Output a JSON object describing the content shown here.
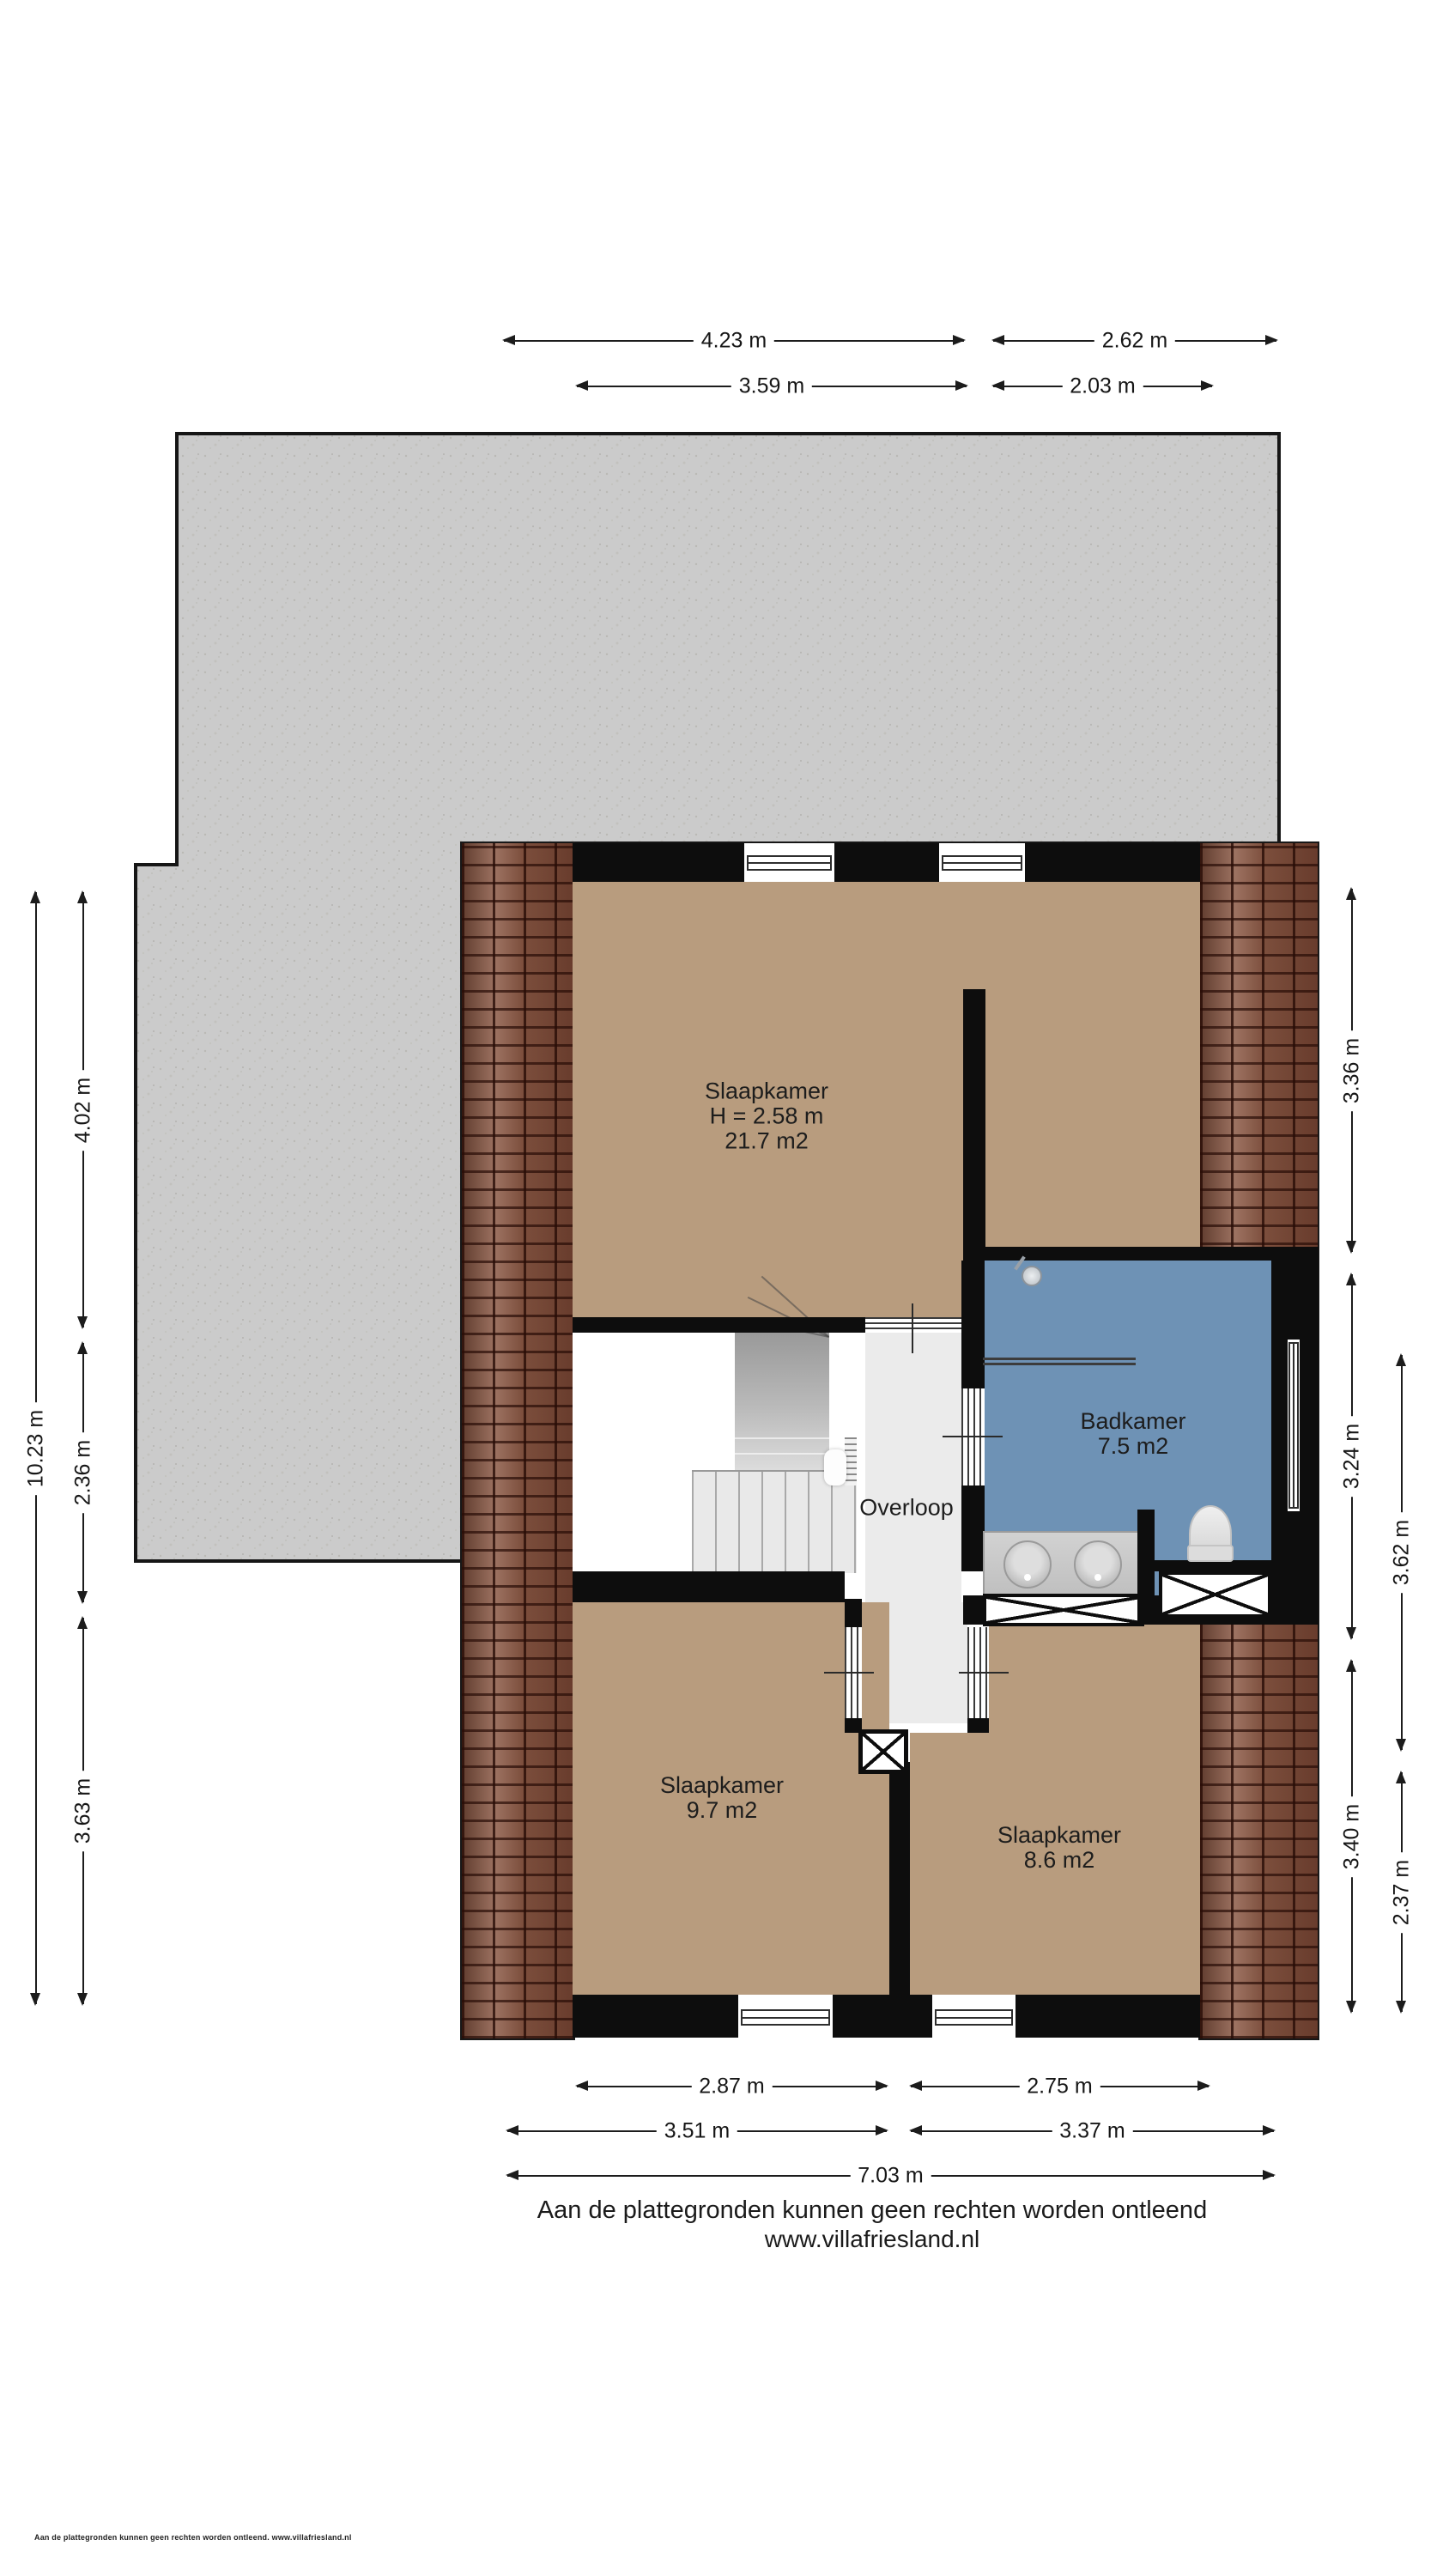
{
  "rooms": {
    "bedroom_main": {
      "name": "Slaapkamer",
      "ceiling": "H = 2.58 m",
      "area": "21.7 m2"
    },
    "bathroom": {
      "name": "Badkamer",
      "area": "7.5 m2"
    },
    "landing": {
      "name": "Overloop"
    },
    "bedroom_left": {
      "name": "Slaapkamer",
      "area": "9.7 m2"
    },
    "bedroom_right": {
      "name": "Slaapkamer",
      "area": "8.6 m2"
    }
  },
  "dimensions": {
    "top_outer_left": "4.23 m",
    "top_outer_right": "2.62 m",
    "top_inner_left": "3.59 m",
    "top_inner_right": "2.03 m",
    "left_total": "10.23 m",
    "left_top": "4.02 m",
    "left_mid": "2.36 m",
    "left_bottom": "3.63 m",
    "right_top": "3.36 m",
    "right_mid": "3.24 m",
    "right_bottom": "3.40 m",
    "right_outer_top": "3.62 m",
    "right_outer_bottom": "2.37 m",
    "bottom_inner_left": "2.87 m",
    "bottom_inner_right": "2.75 m",
    "bottom_mid_left": "3.51 m",
    "bottom_mid_right": "3.37 m",
    "bottom_total": "7.03 m"
  },
  "footer": {
    "disclaimer": "Aan de plattegronden kunnen geen rechten worden ontleend",
    "website": "www.villafriesland.nl"
  },
  "smallprint": "Aan de plattegronden kunnen geen rechten worden ontleend. www.villafriesland.nl",
  "colors": {
    "tan": "#b89c7e",
    "blue": "#6e92b5",
    "landing": "#ebebeb",
    "wall": "#0d0d0d",
    "roof": "#cbcbcb",
    "brick": "#8a5743",
    "dim": "#1c1c1c"
  }
}
